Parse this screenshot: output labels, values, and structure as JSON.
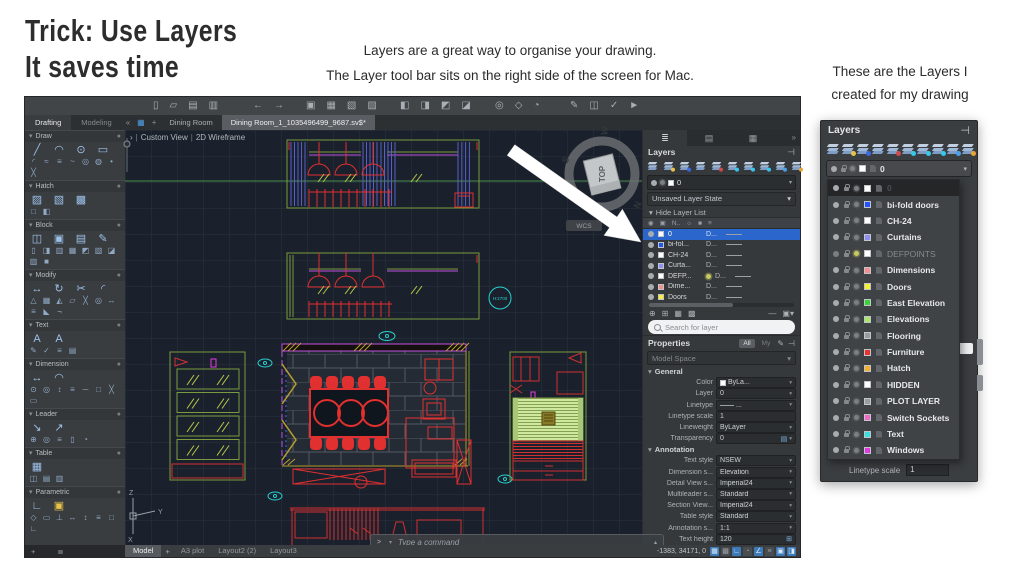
{
  "slide": {
    "title_line1": "Trick: Use Layers",
    "title_line2": "It saves time",
    "subtitle_line1": "Layers are a great way to organise your drawing.",
    "subtitle_line2": "The Layer tool bar sits on the right side of the screen for Mac.",
    "caption_line1": "These are the Layers I",
    "caption_line2": "created for my drawing"
  },
  "cad": {
    "toolbar_groups": [
      {
        "x": 128,
        "icons": [
          [
            "new-file",
            "▯"
          ],
          [
            "open-file",
            "▱"
          ],
          [
            "save",
            "▤"
          ],
          [
            "save-as",
            "▥"
          ]
        ]
      },
      {
        "x": 228,
        "icons": [
          [
            "undo",
            "←"
          ],
          [
            "redo",
            "→"
          ]
        ]
      },
      {
        "x": 281,
        "icons": [
          [
            "print",
            "▣"
          ],
          [
            "print-preview",
            "▦"
          ],
          [
            "page-setup",
            "▧"
          ],
          [
            "plot",
            "▨"
          ]
        ]
      },
      {
        "x": 375,
        "icons": [
          [
            "etransmit",
            "◧"
          ],
          [
            "export",
            "◨"
          ],
          [
            "open-folder",
            "◩"
          ],
          [
            "share-cloud",
            "◪"
          ]
        ]
      },
      {
        "x": 470,
        "icons": [
          [
            "search",
            "◎"
          ],
          [
            "pan",
            "◇"
          ],
          [
            "orbit",
            "◔"
          ]
        ]
      },
      {
        "x": 545,
        "icons": [
          [
            "markup",
            "✎"
          ],
          [
            "markup-import",
            "◫"
          ],
          [
            "markup-assist",
            "✓"
          ],
          [
            "publish",
            "►"
          ]
        ]
      }
    ],
    "workspace_tabs": [
      {
        "label": "Drafting",
        "active": true
      },
      {
        "label": "Modeling",
        "active": false
      }
    ],
    "collapse_icon": "«",
    "grid_icon": "▦",
    "new_tab_icon": "+",
    "doc_tabs": [
      {
        "label": "Dining Room",
        "active": false
      },
      {
        "label": "Dining Room_1_1035496499_9687.sv$*",
        "active": true
      }
    ],
    "viewport": {
      "prefix": "›",
      "view": "Custom View",
      "style": "2D Wireframe"
    },
    "annotation_bubble": "H:2700",
    "viewcube": {
      "top": "TOP",
      "w": "W",
      "s": "S",
      "n": "N",
      "wcs": "WCS"
    },
    "ucs": {
      "x": "X",
      "y": "Y",
      "z": "Z"
    },
    "palette_sections": [
      {
        "label": "Draw",
        "primary": [
          [
            "line",
            "╱"
          ],
          [
            "arc",
            "◠"
          ],
          [
            "circle",
            "⊙"
          ],
          [
            "rectangle",
            "▭"
          ]
        ],
        "secondary": [
          [
            "fillet",
            "◜"
          ],
          [
            "polyline",
            "≈"
          ],
          [
            "multiline",
            "≡"
          ],
          [
            "spline",
            "~"
          ],
          [
            "ellipse",
            "◎"
          ],
          [
            "donut",
            "◍"
          ],
          [
            "point",
            "•"
          ],
          [
            "construction-line",
            "╳"
          ]
        ]
      },
      {
        "label": "Hatch",
        "primary": [
          [
            "hatch",
            "▨"
          ],
          [
            "hatch-pattern",
            "▧"
          ],
          [
            "gradient",
            "▩"
          ]
        ],
        "secondary": [
          [
            "boundary",
            "□"
          ],
          [
            "region",
            "◧"
          ]
        ]
      },
      {
        "label": "Block",
        "primary": [
          [
            "insert-block",
            "◫"
          ],
          [
            "create-block",
            "▣"
          ],
          [
            "write-block",
            "▤"
          ],
          [
            "block-editor",
            "✎"
          ]
        ],
        "secondary": [
          [
            "attr-define",
            "▯"
          ],
          [
            "attr-edit",
            "◨"
          ],
          [
            "attr-manage",
            "▥"
          ],
          [
            "attr-sync",
            "▦"
          ],
          [
            "xref",
            "◩"
          ],
          [
            "image",
            "▧"
          ],
          [
            "underlay",
            "◪"
          ],
          [
            "dwf",
            "▨"
          ],
          [
            "point-cloud",
            "■"
          ]
        ]
      },
      {
        "label": "Modify",
        "primary": [
          [
            "move",
            "↔"
          ],
          [
            "rotate",
            "↻"
          ],
          [
            "trim",
            "✂"
          ],
          [
            "fillet-edge",
            "◜"
          ]
        ],
        "secondary": [
          [
            "scale",
            "△"
          ],
          [
            "array",
            "▦"
          ],
          [
            "mirror",
            "◭"
          ],
          [
            "erase",
            "▱"
          ],
          [
            "explode",
            "╳"
          ],
          [
            "offset",
            "◎"
          ],
          [
            "stretch",
            "↔"
          ],
          [
            "join",
            "≡"
          ],
          [
            "chamfer",
            "◣"
          ],
          [
            "break",
            "¬"
          ]
        ]
      },
      {
        "label": "Text",
        "primary": [
          [
            "mtext",
            "A"
          ],
          [
            "text",
            "A"
          ]
        ],
        "secondary": [
          [
            "edit-text",
            "✎"
          ],
          [
            "spell-check",
            "✓"
          ],
          [
            "text-align",
            "≡"
          ],
          [
            "field",
            "▤"
          ]
        ]
      },
      {
        "label": "Dimension",
        "primary": [
          [
            "dim-linear",
            "↔"
          ],
          [
            "dim-angular",
            "◠"
          ]
        ],
        "secondary": [
          [
            "dim-radius",
            "⊙"
          ],
          [
            "dim-diameter",
            "◎"
          ],
          [
            "dim-ordinate",
            "↕"
          ],
          [
            "dim-baseline",
            "≡"
          ],
          [
            "dim-continue",
            "─"
          ],
          [
            "tolerance",
            "□"
          ],
          [
            "center-mark",
            "╳"
          ],
          [
            "dim-style",
            "▭"
          ]
        ]
      },
      {
        "label": "Leader",
        "primary": [
          [
            "mleader",
            "↘"
          ],
          [
            "mleader-edit",
            "↗"
          ]
        ],
        "secondary": [
          [
            "add-leader",
            "⊕"
          ],
          [
            "remove-leader",
            "◎"
          ],
          [
            "align-leaders",
            "≡"
          ],
          [
            "collect-leaders",
            "▯"
          ],
          [
            "mleader-style",
            "◔"
          ]
        ]
      },
      {
        "label": "Table",
        "primary": [
          [
            "table",
            "▦"
          ]
        ],
        "secondary": [
          [
            "data-link",
            "◫"
          ],
          [
            "table-export",
            "▤"
          ],
          [
            "table-style",
            "▥"
          ]
        ]
      },
      {
        "label": "Parametric",
        "primary": [
          [
            "geometric-constraint",
            "∟"
          ],
          [
            "lock-constraint",
            "▣",
            "#e8c24a"
          ]
        ],
        "secondary": [
          [
            "coincident",
            "◇"
          ],
          [
            "parallel",
            "▭"
          ],
          [
            "perpendicular",
            "⊥"
          ],
          [
            "horizontal",
            "↔"
          ],
          [
            "vertical",
            "↕"
          ],
          [
            "equal",
            "≡"
          ],
          [
            "fix",
            "□"
          ],
          [
            "auto-constrain",
            "∟"
          ]
        ]
      }
    ],
    "layers_panel": {
      "tabs": [
        [
          "layers-tab",
          "≣"
        ],
        [
          "sheet-set-tab",
          "▤"
        ],
        [
          "blocks-tab",
          "▦"
        ]
      ],
      "overflow_icon": "»",
      "title": "Layers",
      "dock_icon": "⊣",
      "tool_badges": [
        null,
        "#e8c24a",
        "#3a6ae0",
        null,
        "#d04a4a",
        "#35c8e8",
        "#35c8e8",
        "#35c8e8",
        "#4aa0e8",
        "#e8a435"
      ],
      "current_layer": "0",
      "layer_state": "Unsaved Layer State",
      "state_caret": "▾",
      "hide_label": "Hide Layer List",
      "hide_caret": "▾",
      "col_headers": [
        "◉",
        "▣",
        "N..",
        "☼",
        "■",
        "≡"
      ],
      "rows": [
        {
          "name": "0",
          "color": "#ffffff",
          "col": "D...",
          "selected": true
        },
        {
          "name": "bi-fol...",
          "color": "#2255ee",
          "col": "D..."
        },
        {
          "name": "CH-24",
          "color": "#ffffff",
          "col": "D..."
        },
        {
          "name": "Curta...",
          "color": "#9090f0",
          "col": "D..."
        },
        {
          "name": "DEFP...",
          "color": "#ffffff",
          "col": "D...",
          "sun": true
        },
        {
          "name": "Dime...",
          "color": "#f49090",
          "col": "D..."
        },
        {
          "name": "Doors",
          "color": "#f5f032",
          "col": "D..."
        }
      ],
      "footer_tools": [
        "⊕",
        "⊞",
        "▦",
        "▩"
      ],
      "footer_right": [
        "—",
        "▣▾"
      ],
      "search_placeholder": "Search for layer"
    },
    "properties_panel": {
      "title": "Properties",
      "filter_all": "All",
      "filter_my": "My",
      "head_icons": [
        "✎",
        "⊣"
      ],
      "space": "Model Space",
      "space_caret": "▾",
      "sections": [
        {
          "label": "General",
          "rows": [
            {
              "label": "Color",
              "value": "ByLa...",
              "swatch": "#ffffff"
            },
            {
              "label": "Layer",
              "value": "0"
            },
            {
              "label": "Linetype",
              "value": "...",
              "line": true
            },
            {
              "label": "Linetype scale",
              "value": "1",
              "plain": true
            },
            {
              "label": "Lineweight",
              "value": "ByLayer"
            },
            {
              "label": "Transparency",
              "value": "0",
              "icon": "▤"
            }
          ]
        },
        {
          "label": "Annotation",
          "rows": [
            {
              "label": "Text style",
              "value": "NSEW"
            },
            {
              "label": "Dimension s...",
              "value": "Elevation"
            },
            {
              "label": "Detail View s...",
              "value": "Imperial24"
            },
            {
              "label": "Multileader s...",
              "value": "Standard"
            },
            {
              "label": "Section View...",
              "value": "Imperial24"
            },
            {
              "label": "Table style",
              "value": "Standard"
            },
            {
              "label": "Annotation s...",
              "value": "1:1"
            },
            {
              "label": "Text height",
              "value": "120",
              "icon": "⊞",
              "plain": true
            }
          ]
        }
      ]
    },
    "command_line": {
      "prompt": ">_",
      "prompt_caret": "▾",
      "placeholder": "Type a command",
      "up_caret": "▴"
    },
    "status_bar": {
      "add_icon": "+",
      "stack_icon": "≣",
      "model_tab": "Model",
      "plus_tab": "+",
      "layout_tabs": [
        "A3 plot",
        "Layout2 (2)",
        "Layout3"
      ],
      "coords": "-1383, 34171, 0",
      "icons": [
        {
          "name": "grid",
          "g": "▦",
          "on": true
        },
        {
          "name": "snap",
          "g": "▩",
          "on": false
        },
        {
          "name": "ortho",
          "g": "∟",
          "on": true
        },
        {
          "name": "polar",
          "g": "◔",
          "on": false
        },
        {
          "name": "isodraft",
          "g": "∠",
          "on": true
        },
        {
          "name": "lineweight-display",
          "g": "≡",
          "on": false
        },
        {
          "name": "object-snap",
          "g": "▣",
          "on": true
        },
        {
          "name": "dynamic-input",
          "g": "◨",
          "on": true
        }
      ]
    }
  },
  "layers_popup": {
    "title": "Layers",
    "dock_icon": "⊣",
    "tool_badges": [
      null,
      "#e8c24a",
      "#3a6ae0",
      null,
      "#d04a4a",
      "#35c8e8",
      "#35c8e8",
      "#35c8e8",
      "#4aa0e8",
      "#e8a435"
    ],
    "current_layer": "0",
    "caret": "▾",
    "rows": [
      {
        "name": "0",
        "color": "#ffffff",
        "selected": true
      },
      {
        "name": "bi-fold doors",
        "color": "#2255ff"
      },
      {
        "name": "CH-24",
        "color": "#ffffff"
      },
      {
        "name": "Curtains",
        "color": "#9090f0"
      },
      {
        "name": "DEFPOINTS",
        "color": "#ffffff",
        "dim": true,
        "sun": true
      },
      {
        "name": "Dimensions",
        "color": "#f49090"
      },
      {
        "name": "Doors",
        "color": "#f5f032"
      },
      {
        "name": "East Elevation",
        "color": "#3ad43a"
      },
      {
        "name": "Elevations",
        "color": "#a8e86a"
      },
      {
        "name": "Flooring",
        "color": "#9a9da0"
      },
      {
        "name": "Furniture",
        "color": "#e83232"
      },
      {
        "name": "Hatch",
        "color": "#f2b02c"
      },
      {
        "name": "HIDDEN",
        "color": "#ffffff"
      },
      {
        "name": "PLOT LAYER",
        "color": "#9a9da0"
      },
      {
        "name": "Switch Sockets",
        "color": "#f068c8"
      },
      {
        "name": "Text",
        "color": "#38e0e0"
      },
      {
        "name": "Windows",
        "color": "#e03ae0"
      }
    ],
    "footer_label": "Linetype scale",
    "footer_value": "1"
  }
}
